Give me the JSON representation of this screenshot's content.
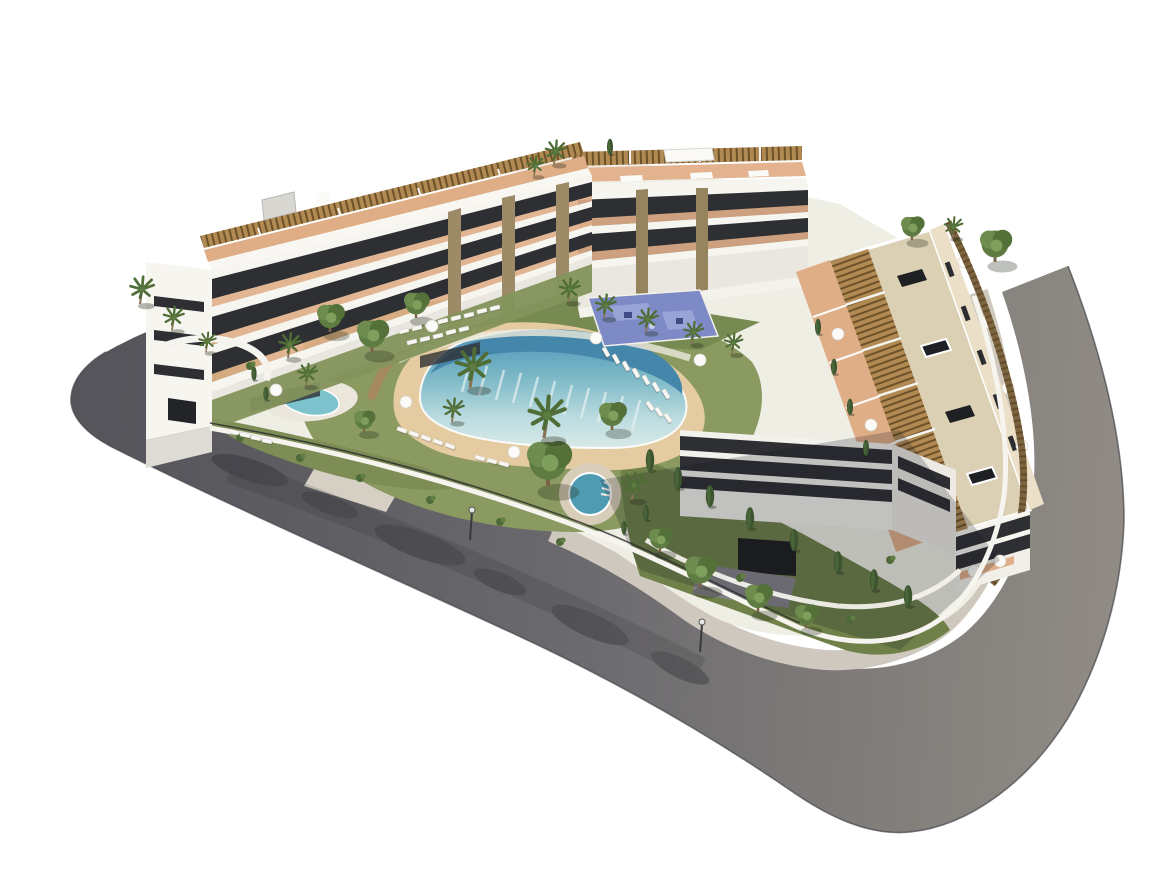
{
  "scene": {
    "type": "3d-architectural-render",
    "view": "aerial-isometric",
    "description": "Aerial 3D rendering of a modern white residential complex: three apartment blocks with slatted rooftop pergolas and terracotta terraces arranged around a landscaped courtyard with a lagoon-style pool, sandy beach edge, circular spa, small kidney pool, blue playground and palm gardens, all wrapped by a curving grey road with light sidewalk on a plain white background",
    "elements": {
      "buildings": [
        "left apartment block with stepped balconies and rooftop pergolas",
        "rear apartment block with rooftop pergolas and roof box",
        "right apartment block with beige roof deck, dark skylights and pergola strips"
      ],
      "amenities": [
        "lagoon-style swimming pool with infinity edge",
        "sandy beach entry",
        "circular spa pool",
        "kidney-shaped children's pool",
        "blue playground court",
        "rows of white sun loungers",
        "white parasols",
        "lawns with palm, leafy and cypress trees"
      ],
      "surroundings": [
        "curving perimeter road",
        "light sidewalk band",
        "white perimeter garden walls with dark fencing",
        "tree shadows cast on the asphalt",
        "street lamps",
        "garage entrance with driveway"
      ]
    }
  },
  "colors": {
    "background": "#ffffff",
    "road_dark": "#55555b",
    "road_mid": "#6a696d",
    "road_light": "#908b84",
    "sidewalk": "#cfc8be",
    "curb": "#44444a",
    "site_ground": "#efeee5",
    "lawn": "#8a9a60",
    "garden_dark": "#6f8148",
    "foliage": "#5e7c42",
    "cypress": "#3c5530",
    "sand": "#e5cba1",
    "pool_deep": "#4586ab",
    "pool_mid": "#7fbac8",
    "pool_pale": "#dcebe8",
    "spa_water": "#4f9cb2",
    "kidney_water": "#7cc3cd",
    "playground": "#7d8ac6",
    "building_white": "#f7f5f0",
    "building_shade": "#e9e7e0",
    "glass_dark": "#2e2f33",
    "terracotta": "#dfae87",
    "pergola_wood": "#b08a52",
    "pergola_slat": "#6d5128",
    "roof_beige": "#dbcfb4",
    "stone_pier": "#9d8a66",
    "garage_dark": "#1d1e21",
    "lounger_white": "#f8f7f3",
    "shadow": "#1f1f24"
  }
}
